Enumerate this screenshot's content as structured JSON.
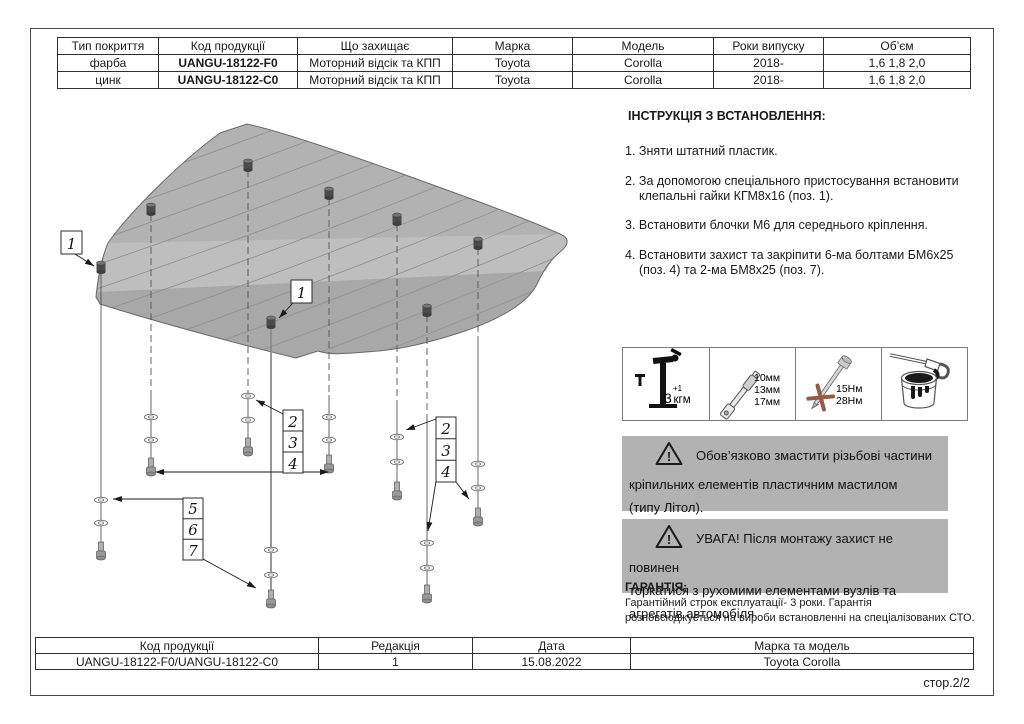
{
  "product_table": {
    "headers": [
      "Тип покриття",
      "Код продукції",
      "Що захищає",
      "Марка",
      "Модель",
      "Роки випуску",
      "Об’єм"
    ],
    "rows": [
      {
        "coating": "фарба",
        "code": "UANGU-18122-F0",
        "protects": "Моторний відсік та КПП",
        "brand": "Toyota",
        "model": "Corolla",
        "years": "2018-",
        "volume": "1,6 1,8 2,0"
      },
      {
        "coating": "цинк",
        "code": "UANGU-18122-C0",
        "protects": "Моторний відсік та КПП",
        "brand": "Toyota",
        "model": "Corolla",
        "years": "2018-",
        "volume": "1,6 1,8 2,0"
      }
    ]
  },
  "instructions": {
    "title": "ІНСТРУКЦІЯ З ВСТАНОВЛЕННЯ:",
    "steps": [
      {
        "lines": [
          "1. Зняти штатний пластик."
        ]
      },
      {
        "lines": [
          "2. За допомогою спеціального пристосування встановити",
          "клепальні гайки КГМ8х16 (поз. 1)."
        ]
      },
      {
        "lines": [
          "3. Встановити блочки М6 для середнього кріплення."
        ]
      },
      {
        "lines": [
          "4. Встановити захист та закріпити 6-ма болтами БМ6х25",
          "(поз. 4) та 2-ма БМ8х25 (поз. 7)."
        ]
      }
    ]
  },
  "tools": {
    "rivet": {
      "icon": "rivet-nut-tool-icon",
      "value": "3",
      "sup": "+1",
      "unit": "кгм"
    },
    "wrench": {
      "icon": "torque-wrench-icon",
      "lines": [
        "10мм",
        "13мм",
        "17мм"
      ]
    },
    "bolt": {
      "icon": "mounting-bolt-icon",
      "lines": [
        "15Нм",
        "28Нм"
      ]
    },
    "grease": {
      "icon": "grease-bucket-icon"
    }
  },
  "warnings": [
    {
      "icon": "warning-triangle-icon",
      "lines": [
        "Обов’язково змастити різьбові частини",
        "кріпильних елементів пластичним мастилом",
        "(типу Літол)."
      ]
    },
    {
      "icon": "warning-triangle-icon",
      "lines": [
        "УВАГА! Після монтажу захист не повинен",
        "торкатися з рухомими елементами вузлів та",
        "агрегатів автомобіля."
      ]
    }
  ],
  "warranty": {
    "title": "ГАРАНТІЯ:",
    "lines": [
      "Гарантійний строк експлуатації- 3 роки. Гарантія",
      "розповсюджується на вироби встановленні на спеціалізованих СТО."
    ]
  },
  "footer_table": {
    "headers": [
      "Код продукції",
      "Редакція",
      "Дата",
      "Марка та модель"
    ],
    "values": {
      "code": "UANGU-18122-F0/UANGU-18122-C0",
      "revision": "1",
      "date": "15.08.2022",
      "brand_model": "Toyota Corolla"
    }
  },
  "page_label": "стор.2/2",
  "diagram": {
    "callout_left": "1",
    "callout_center": "1",
    "stack_mid": [
      "2",
      "3",
      "4"
    ],
    "stack_right": [
      "2",
      "3",
      "4"
    ],
    "stack_left": [
      "5",
      "6",
      "7"
    ]
  },
  "colors": {
    "warning_bg": "#b2b2b2",
    "plate_gray": "#a8a8a8",
    "accent_ink": "#1a1a1a"
  }
}
